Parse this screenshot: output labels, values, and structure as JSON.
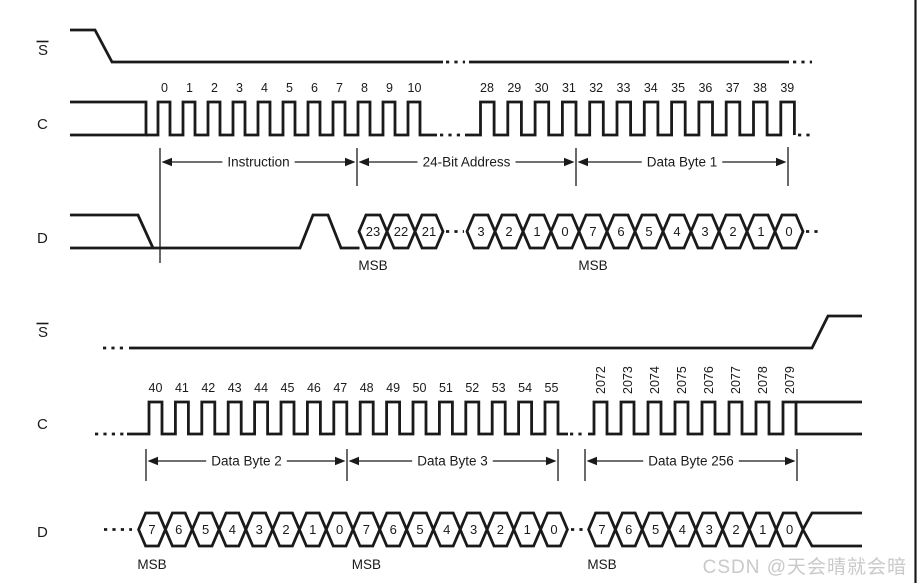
{
  "diagram": {
    "line_color": "#1a1a1a",
    "signal_labels": {
      "select": "S",
      "clock": "C",
      "data": "D"
    },
    "top_half": {
      "clock_groups": [
        {
          "numbers": [
            "0",
            "1",
            "2",
            "3",
            "4",
            "5",
            "6",
            "7",
            "8",
            "9",
            "10"
          ],
          "orientation": "horizontal"
        },
        {
          "numbers": [
            "28",
            "29",
            "30",
            "31",
            "32",
            "33",
            "34",
            "35",
            "36",
            "37",
            "38",
            "39"
          ],
          "orientation": "horizontal"
        }
      ],
      "phases": [
        {
          "label": "Instruction"
        },
        {
          "label": "24-Bit Address"
        },
        {
          "label": "Data Byte 1"
        }
      ],
      "data_cell_groups": [
        {
          "cells": [
            "23",
            "22",
            "21"
          ]
        },
        {
          "cells": [
            "3",
            "2",
            "1",
            "0",
            "7",
            "6",
            "5",
            "4",
            "3",
            "2",
            "1",
            "0"
          ]
        }
      ],
      "msb_labels": [
        "MSB",
        "MSB"
      ]
    },
    "bottom_half": {
      "clock_groups": [
        {
          "numbers": [
            "40",
            "41",
            "42",
            "43",
            "44",
            "45",
            "46",
            "47",
            "48",
            "49",
            "50",
            "51",
            "52",
            "53",
            "54",
            "55"
          ],
          "orientation": "horizontal"
        },
        {
          "numbers": [
            "2072",
            "2073",
            "2074",
            "2075",
            "2076",
            "2077",
            "2078",
            "2079"
          ],
          "orientation": "vertical"
        }
      ],
      "phases": [
        {
          "label": "Data Byte 2"
        },
        {
          "label": "Data Byte 3"
        },
        {
          "label": "Data Byte 256"
        }
      ],
      "data_cell_groups": [
        {
          "cells": [
            "7",
            "6",
            "5",
            "4",
            "3",
            "2",
            "1",
            "0",
            "7",
            "6",
            "5",
            "4",
            "3",
            "2",
            "1",
            "0"
          ]
        },
        {
          "cells": [
            "7",
            "6",
            "5",
            "4",
            "3",
            "2",
            "1",
            "0"
          ]
        }
      ],
      "msb_labels": [
        "MSB",
        "MSB",
        "MSB"
      ]
    }
  },
  "watermark": {
    "text": "CSDN @天会晴就会暗",
    "color": "#c9c9c9"
  }
}
